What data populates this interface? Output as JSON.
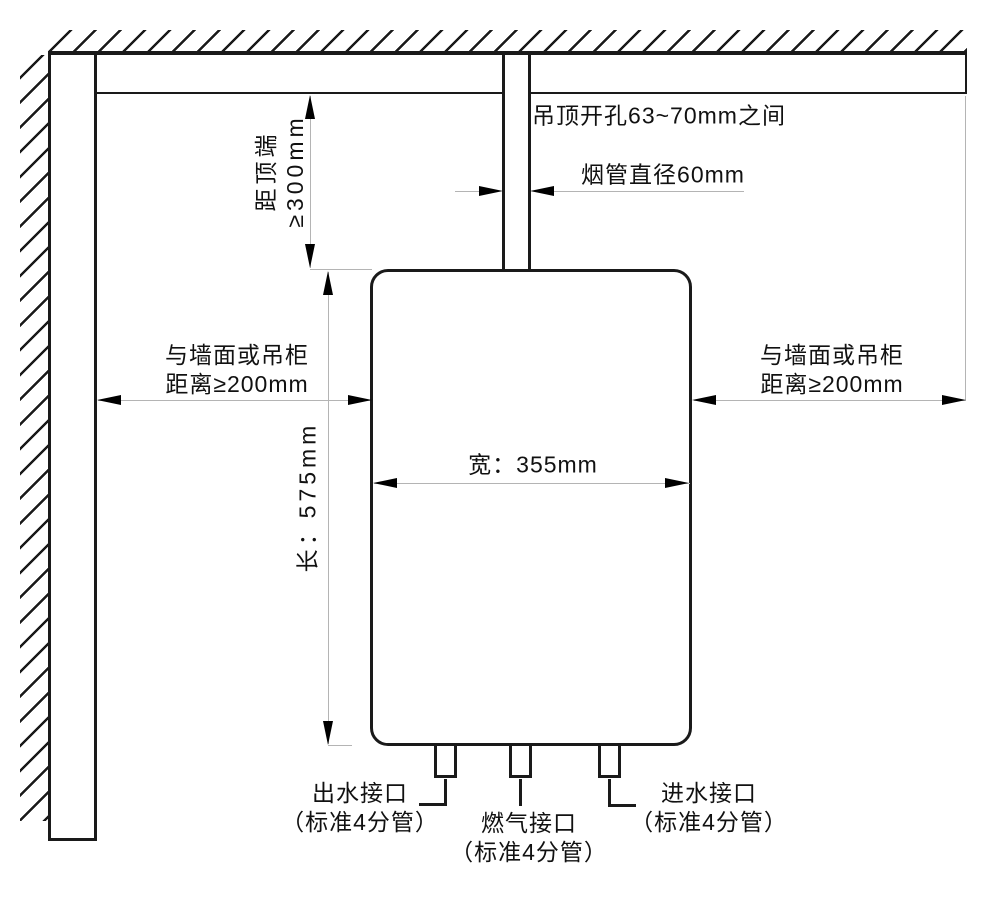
{
  "diagram": {
    "type": "gas-water-heater-installation-clearance-diagram",
    "colors": {
      "outline": "#1a1a1a",
      "dimension_line": "#b4b4b4",
      "background": "#ffffff"
    },
    "ceiling": {
      "opening_label": "吊顶开孔63~70mm之间"
    },
    "flue": {
      "diameter_label": "烟管直径60mm"
    },
    "clearances": {
      "top": {
        "line1": "距顶端",
        "line2": "≥300mm"
      },
      "left": {
        "line1": "与墙面或吊柜",
        "line2": "距离≥200mm"
      },
      "right": {
        "line1": "与墙面或吊柜",
        "line2": "距离≥200mm"
      }
    },
    "heater": {
      "width_label": "宽：355mm",
      "height_label": "长：575mm"
    },
    "connections": {
      "outlet": {
        "line1": "出水接口",
        "line2": "（标准4分管）"
      },
      "gas": {
        "line1": "燃气接口",
        "line2": "（标准4分管）"
      },
      "inlet": {
        "line1": "进水接口",
        "line2": "（标准4分管）"
      }
    }
  }
}
